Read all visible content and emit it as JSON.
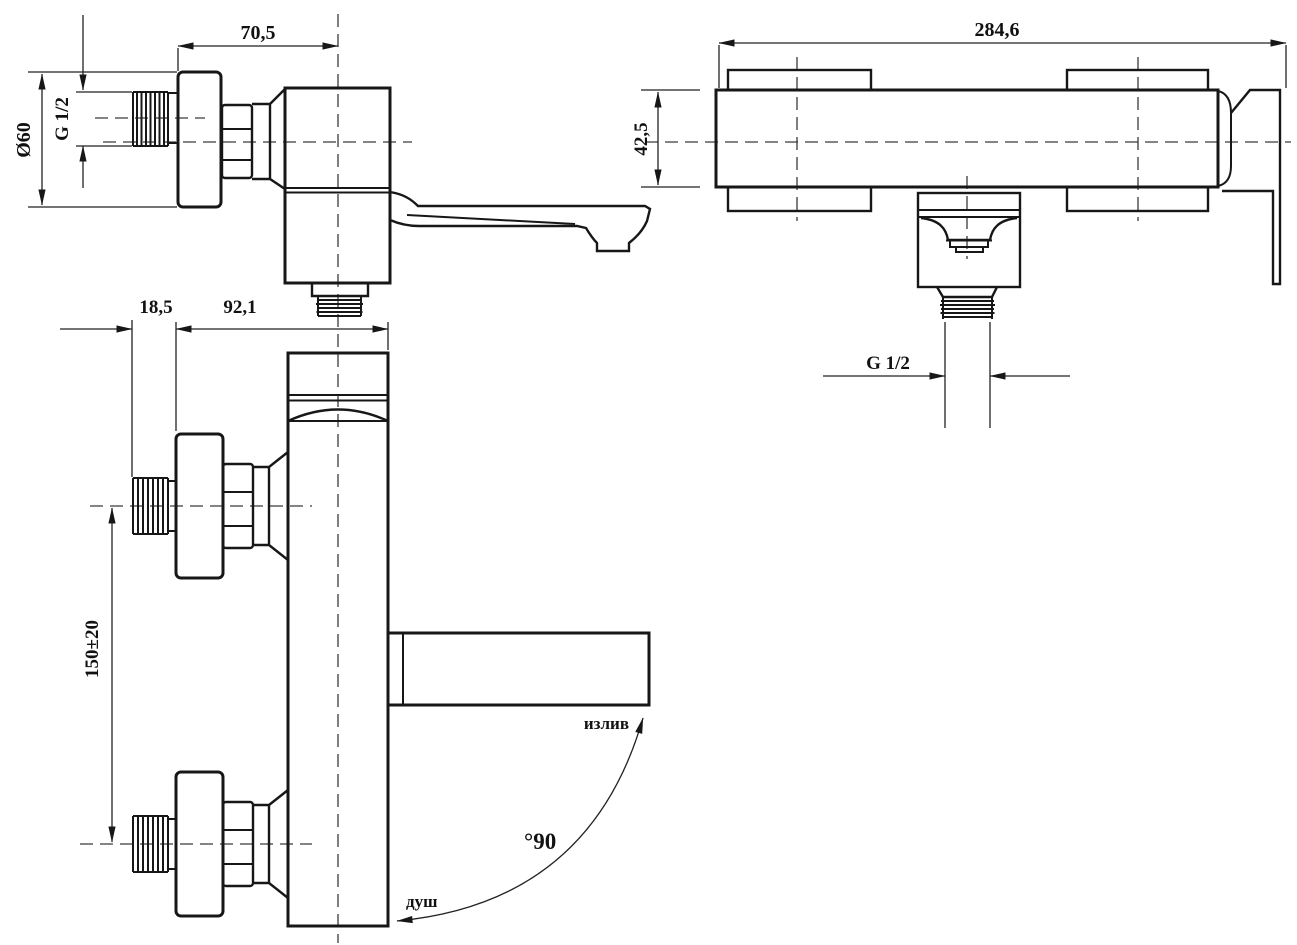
{
  "colors": {
    "background": "#ffffff",
    "line": "#171717",
    "text": "#111111"
  },
  "views": {
    "top_left": {
      "dim_width": "70,5",
      "dim_diameter": "Ø60",
      "dim_thread": "G 1/2"
    },
    "top_right": {
      "dim_length": "284,6",
      "dim_height": "42,5",
      "dim_thread": "G 1/2"
    },
    "bottom_left": {
      "dim_wall_offset": "18,5",
      "dim_depth": "92,1",
      "dim_pipe_spacing": "150±20",
      "label_spout": "излив",
      "label_shower": "душ",
      "label_angle": "°90"
    }
  }
}
